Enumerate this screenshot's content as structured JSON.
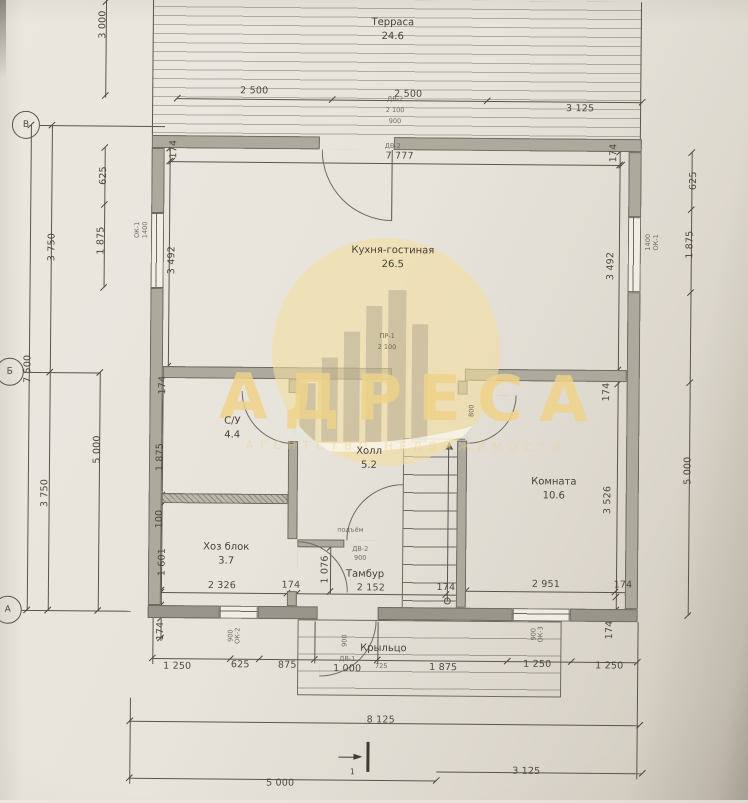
{
  "meta": {
    "type": "floor-plan",
    "language": "ru",
    "ink_color": "#5a554c",
    "wall_color": "#adaa9d",
    "paper_color": "#e7e4dc"
  },
  "watermark": {
    "title": "АДРЕСА",
    "subtitle": "АГЕНТСТВО НЕДВИЖИМОСТИ",
    "icon": "building-circle-emblem",
    "gold_color": "#eed29a"
  },
  "rooms": [
    {
      "id": "terrace",
      "label": "Терраса",
      "area": "24.6",
      "x": 390,
      "y": 30
    },
    {
      "id": "kitchen-living",
      "label": "Кухня-гостиная",
      "area": "26.5",
      "x": 392,
      "y": 258
    },
    {
      "id": "bathroom",
      "label": "С/У",
      "area": "4.4",
      "x": 233,
      "y": 430
    },
    {
      "id": "hall",
      "label": "Холл",
      "area": "5.2",
      "x": 370,
      "y": 459
    },
    {
      "id": "utility",
      "label": "Хоз блок",
      "area": "3.7",
      "x": 228,
      "y": 556
    },
    {
      "id": "room",
      "label": "Комната",
      "area": "10.6",
      "x": 555,
      "y": 488
    },
    {
      "id": "vestibule",
      "label": "Тамбур",
      "area": "",
      "x": 367,
      "y": 575
    },
    {
      "id": "porch",
      "label": "Крыльцо",
      "area": "",
      "x": 386,
      "y": 649
    }
  ],
  "axis_markers": [
    {
      "label": "В",
      "x": 24,
      "y": 128,
      "bubble": true
    },
    {
      "label": "Б",
      "x": 10,
      "y": 375,
      "bubble": true
    },
    {
      "label": "А",
      "x": 10,
      "y": 613,
      "bubble": true
    },
    {
      "label": "1",
      "x": 356,
      "y": 772,
      "bubble": false
    }
  ],
  "dimensions": [
    [
      "2 500",
      252,
      92,
      0
    ],
    [
      "2 500",
      406,
      94,
      0
    ],
    [
      "3 125",
      578,
      107,
      0
    ],
    [
      "7 777",
      398,
      156,
      0
    ],
    [
      "3 000",
      100,
      27,
      -90
    ],
    [
      "625",
      102,
      178,
      -90
    ],
    [
      "1 875",
      100,
      243,
      -90
    ],
    [
      "3 750",
      51,
      250,
      -90
    ],
    [
      "7 500",
      28,
      372,
      -90
    ],
    [
      "5 000",
      98,
      452,
      -90
    ],
    [
      "3 750",
      46,
      496,
      -90
    ],
    [
      "174",
      172,
      151,
      -90
    ],
    [
      "3 492",
      171,
      262,
      -90
    ],
    [
      "174",
      163,
      387,
      -90
    ],
    [
      "1 875",
      161,
      459,
      -90
    ],
    [
      "100",
      161,
      521,
      -90
    ],
    [
      "1 601",
      164,
      564,
      -90
    ],
    [
      "174",
      163,
      633,
      -90
    ],
    [
      "174",
      612,
      151,
      -90
    ],
    [
      "3 492",
      610,
      264,
      -90
    ],
    [
      "174",
      607,
      390,
      -90
    ],
    [
      "3 526",
      609,
      498,
      -90
    ],
    [
      "174",
      612,
      628,
      -90
    ],
    [
      "625",
      692,
      178,
      -90
    ],
    [
      "1 875",
      689,
      242,
      -90
    ],
    [
      "5 000",
      689,
      468,
      -90
    ],
    [
      "2 326",
      224,
      587,
      0
    ],
    [
      "174",
      293,
      586,
      0
    ],
    [
      "2 152",
      373,
      588,
      0
    ],
    [
      "174",
      448,
      587,
      0
    ],
    [
      "1 076",
      327,
      570,
      -90
    ],
    [
      "2 951",
      548,
      583,
      0
    ],
    [
      "174",
      625,
      583,
      0
    ],
    [
      "1 250",
      180,
      668,
      0
    ],
    [
      "625",
      243,
      666,
      0
    ],
    [
      "875",
      290,
      666,
      0
    ],
    [
      "1 000",
      350,
      669,
      0
    ],
    [
      "1 875",
      446,
      667,
      0
    ],
    [
      "1 250",
      540,
      663,
      0
    ],
    [
      "1 250",
      612,
      664,
      0
    ],
    [
      "8 125",
      384,
      720,
      0
    ],
    [
      "5 000",
      284,
      784,
      0
    ],
    [
      "3 125",
      530,
      770,
      0
    ]
  ],
  "door_window_marks": [
    [
      "ДВ-2",
      393,
      99,
      0
    ],
    [
      "2 100",
      393,
      110,
      0
    ],
    [
      "900",
      393,
      121,
      0
    ],
    [
      "ДВ-2",
      391,
      146,
      0
    ],
    [
      "ПР-1",
      387,
      336,
      0
    ],
    [
      "2 100",
      387,
      347,
      0
    ],
    [
      "ОК-1",
      136,
      232,
      -90
    ],
    [
      "1400",
      144,
      232,
      -90
    ],
    [
      "ОК-1",
      655,
      240,
      -90
    ],
    [
      "1400",
      647,
      240,
      -90
    ],
    [
      "ДВ-2",
      362,
      549,
      0
    ],
    [
      "900",
      362,
      558,
      0
    ],
    [
      "800",
      472,
      410,
      -90
    ],
    [
      "подъём",
      352,
      530,
      0
    ],
    [
      "ОК-2",
      240,
      637,
      -90
    ],
    [
      "900",
      233,
      637,
      -90
    ],
    [
      "ОК-3",
      543,
      633,
      -90
    ],
    [
      "900",
      536,
      633,
      -90
    ],
    [
      "ДВ-1",
      350,
      659,
      0
    ],
    [
      "725",
      384,
      666,
      0
    ],
    [
      "900",
      347,
      641,
      -90
    ]
  ]
}
